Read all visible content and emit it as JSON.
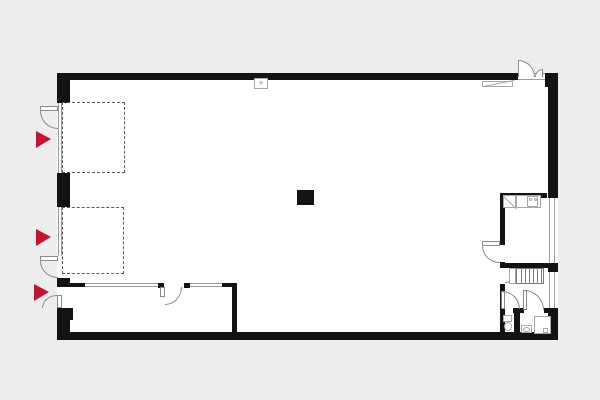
{
  "canvas": {
    "width": 600,
    "height": 400,
    "background": "#ededed",
    "wall_color": "#131313",
    "floor_color": "#ffffff",
    "partition_color": "#9a9a9a",
    "arc_color": "#8a8a8a",
    "fixture_color": "#a8a8a8",
    "dashed_color": "#5a5a5a",
    "accent_red": "#c51230",
    "panel_glyph": "+"
  },
  "plan": {
    "floor": {
      "x": 57,
      "y": 73,
      "w": 501,
      "h": 267,
      "n": "building-floor"
    },
    "walls": [
      {
        "x": 57,
        "y": 73,
        "w": 461,
        "h": 7,
        "n": "exterior-wall-top"
      },
      {
        "x": 545,
        "y": 73,
        "w": 13,
        "h": 14,
        "n": "exterior-wall-corner-top-right"
      },
      {
        "x": 548,
        "y": 80,
        "w": 10,
        "h": 118,
        "n": "exterior-wall-right-upper"
      },
      {
        "x": 548,
        "y": 263,
        "w": 10,
        "h": 9,
        "n": "exterior-wall-right-mid"
      },
      {
        "x": 548,
        "y": 308,
        "w": 10,
        "h": 32,
        "n": "exterior-wall-right-lower"
      },
      {
        "x": 57,
        "y": 332,
        "w": 501,
        "h": 8,
        "n": "exterior-wall-bottom"
      },
      {
        "x": 57,
        "y": 73,
        "w": 13,
        "h": 30,
        "n": "exterior-wall-left-seg1"
      },
      {
        "x": 57,
        "y": 173,
        "w": 13,
        "h": 34,
        "n": "exterior-wall-left-seg2"
      },
      {
        "x": 57,
        "y": 278,
        "w": 13,
        "h": 9,
        "n": "exterior-wall-left-seg3"
      },
      {
        "x": 57,
        "y": 308,
        "w": 13,
        "h": 30,
        "n": "exterior-wall-left-seg4"
      },
      {
        "x": 70,
        "y": 308,
        "w": 3,
        "h": 12,
        "n": "pilaster"
      },
      {
        "x": 500,
        "y": 193,
        "w": 5,
        "h": 52,
        "n": "interior-wall-right-rooms"
      },
      {
        "x": 500,
        "y": 262,
        "w": 5,
        "h": 6,
        "n": "interior-wall-right-rooms"
      },
      {
        "x": 500,
        "y": 284,
        "w": 5,
        "h": 48,
        "n": "interior-wall-right-rooms"
      },
      {
        "x": 500,
        "y": 193,
        "w": 47,
        "h": 5,
        "n": "interior-wall-room-top"
      },
      {
        "x": 500,
        "y": 263,
        "w": 48,
        "h": 5,
        "n": "interior-wall-corridor-top"
      },
      {
        "x": 513,
        "y": 308,
        "w": 11,
        "h": 5,
        "n": "interior-wall-bath-top"
      },
      {
        "x": 544,
        "y": 308,
        "w": 14,
        "h": 5,
        "n": "interior-wall-bath-top"
      },
      {
        "x": 514,
        "y": 313,
        "w": 6,
        "h": 19,
        "n": "interior-wall-bath-divider"
      },
      {
        "x": 57,
        "y": 283,
        "w": 28,
        "h": 4,
        "n": "interior-wall-room-left"
      },
      {
        "x": 158,
        "y": 283,
        "w": 6,
        "h": 5,
        "n": "door-post"
      },
      {
        "x": 184,
        "y": 283,
        "w": 6,
        "h": 5,
        "n": "door-post"
      },
      {
        "x": 222,
        "y": 283,
        "w": 15,
        "h": 4,
        "n": "interior-wall-room-left"
      },
      {
        "x": 232,
        "y": 287,
        "w": 5,
        "h": 45,
        "n": "interior-wall-room-side"
      },
      {
        "x": 297,
        "y": 190,
        "w": 17,
        "h": 15,
        "n": "column"
      }
    ],
    "partitions": [
      {
        "x": 58,
        "y": 103,
        "w": 4,
        "h": 70,
        "dir": "v",
        "n": "bay-door-1"
      },
      {
        "x": 58,
        "y": 207,
        "w": 4,
        "h": 49,
        "dir": "v",
        "n": "bay-door-2"
      },
      {
        "x": 85,
        "y": 283,
        "w": 73,
        "h": 4,
        "dir": "h",
        "n": "glazed-partition"
      },
      {
        "x": 190,
        "y": 283,
        "w": 32,
        "h": 4,
        "dir": "h",
        "n": "glazed-partition"
      },
      {
        "x": 549,
        "y": 198,
        "w": 6,
        "h": 65,
        "dir": "v",
        "n": "window"
      },
      {
        "x": 549,
        "y": 272,
        "w": 6,
        "h": 36,
        "dir": "v",
        "n": "window"
      },
      {
        "x": 518,
        "y": 73,
        "w": 27,
        "h": 7,
        "dir": "h",
        "n": "door-threshold"
      }
    ],
    "dashed_areas": [
      {
        "x": 62,
        "y": 102,
        "w": 63,
        "h": 71,
        "n": "loading-zone-1"
      },
      {
        "x": 62,
        "y": 207,
        "w": 62,
        "h": 67,
        "n": "loading-zone-2"
      }
    ],
    "entry_markers": [
      {
        "x": 36,
        "y": 131,
        "n": "entry-marker-1"
      },
      {
        "x": 36,
        "y": 229,
        "n": "entry-marker-2"
      },
      {
        "x": 34,
        "y": 284,
        "n": "entry-marker-3"
      }
    ],
    "door_leaves": [
      {
        "x": 40,
        "y": 106,
        "w": 18,
        "h": 5,
        "n": "door-leaf"
      },
      {
        "x": 40,
        "y": 256,
        "w": 18,
        "h": 5,
        "n": "door-leaf"
      },
      {
        "x": 57,
        "y": 295,
        "w": 5,
        "h": 13,
        "n": "door-leaf"
      },
      {
        "x": 160,
        "y": 287,
        "w": 5,
        "h": 10,
        "n": "door-leaf"
      },
      {
        "x": 482,
        "y": 241,
        "w": 18,
        "h": 5,
        "n": "door-leaf"
      },
      {
        "x": 501,
        "y": 291,
        "w": 4,
        "h": 18,
        "n": "door-leaf"
      },
      {
        "x": 523,
        "y": 290,
        "w": 4,
        "h": 20,
        "n": "door-leaf"
      }
    ],
    "door_arcs": [
      {
        "x": 40,
        "y": 111,
        "w": 18,
        "h": 18,
        "c": "bl",
        "n": "door-swing"
      },
      {
        "x": 40,
        "y": 261,
        "w": 18,
        "h": 17,
        "c": "bl",
        "n": "door-swing"
      },
      {
        "x": 42,
        "y": 295,
        "w": 15,
        "h": 13,
        "c": "tl",
        "n": "door-swing"
      },
      {
        "x": 165,
        "y": 287,
        "w": 17,
        "h": 18,
        "c": "br",
        "n": "door-swing"
      },
      {
        "x": 482,
        "y": 246,
        "w": 18,
        "h": 17,
        "c": "bl",
        "n": "door-swing"
      },
      {
        "x": 505,
        "y": 269,
        "w": 13,
        "h": 14,
        "c": "br",
        "n": "door-swing"
      },
      {
        "x": 502,
        "y": 291,
        "w": 18,
        "h": 18,
        "c": "tr",
        "n": "door-swing"
      },
      {
        "x": 524,
        "y": 290,
        "w": 20,
        "h": 20,
        "c": "tr",
        "n": "door-swing"
      },
      {
        "x": 518,
        "y": 60,
        "w": 17,
        "h": 17,
        "c": "tr",
        "fill": true,
        "hinge": "l",
        "n": "entrance-door-leaf-large"
      },
      {
        "x": 535,
        "y": 69,
        "w": 8,
        "h": 8,
        "c": "tl",
        "fill": true,
        "hinge": "r",
        "n": "entrance-door-leaf-small"
      }
    ],
    "stairs": {
      "x": 516,
      "y": 268,
      "w": 28,
      "h": 16,
      "steps": 7,
      "n": "staircase"
    },
    "fixtures": [
      {
        "x": 509,
        "y": 268,
        "w": 7,
        "h": 16,
        "shape": "rect",
        "n": "stair-landing"
      },
      {
        "x": 503,
        "y": 195,
        "w": 13,
        "h": 13,
        "shape": "diag-down",
        "n": "kitchen-sink-unit"
      },
      {
        "x": 516,
        "y": 195,
        "w": 25,
        "h": 13,
        "shape": "rect",
        "n": "kitchen-counter"
      },
      {
        "x": 527,
        "y": 196,
        "w": 11,
        "h": 11,
        "shape": "rect",
        "n": "cooktop"
      },
      {
        "x": 529,
        "y": 198,
        "w": 3,
        "h": 3,
        "shape": "round",
        "n": "burner"
      },
      {
        "x": 534,
        "y": 198,
        "w": 3,
        "h": 3,
        "shape": "round",
        "n": "burner"
      },
      {
        "x": 503,
        "y": 315,
        "w": 9,
        "h": 7,
        "shape": "rect",
        "n": "toilet-cistern"
      },
      {
        "x": 504,
        "y": 322,
        "w": 8,
        "h": 9,
        "shape": "oval",
        "n": "toilet-bowl"
      },
      {
        "x": 521,
        "y": 325,
        "w": 11,
        "h": 8,
        "shape": "rect",
        "n": "washbasin"
      },
      {
        "x": 523,
        "y": 327,
        "w": 7,
        "h": 5,
        "shape": "oval",
        "n": "washbasin-bowl"
      },
      {
        "x": 534,
        "y": 316,
        "w": 17,
        "h": 18,
        "shape": "rect",
        "n": "shower"
      },
      {
        "x": 543,
        "y": 328,
        "w": 5,
        "h": 5,
        "shape": "rect",
        "n": "shower-drain"
      },
      {
        "x": 482,
        "y": 81,
        "w": 31,
        "h": 6,
        "shape": "diag-up",
        "n": "ramp"
      },
      {
        "x": 254,
        "y": 78,
        "w": 14,
        "h": 11,
        "shape": "plus-rect",
        "n": "panel"
      }
    ]
  }
}
